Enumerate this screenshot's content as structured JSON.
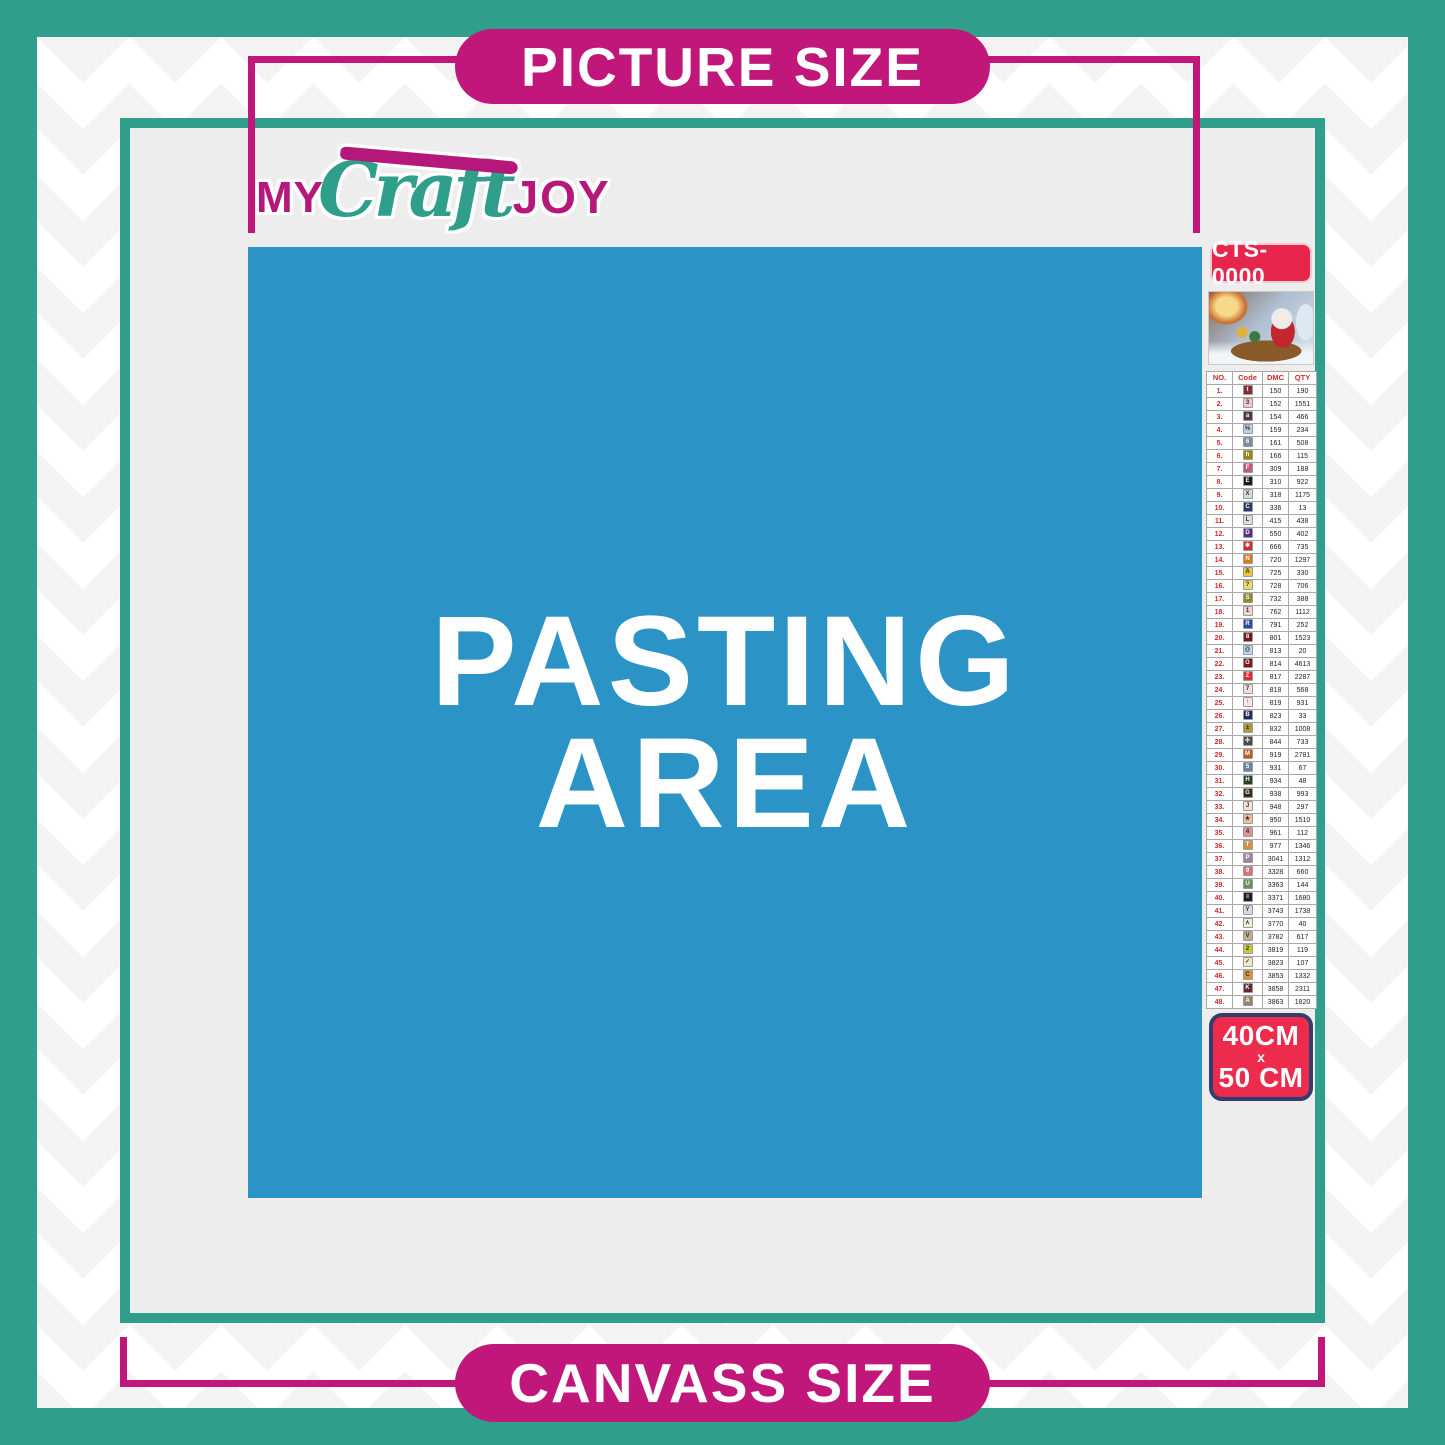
{
  "banners": {
    "top": "PICTURE SIZE",
    "bottom": "CANVASS SIZE"
  },
  "logo": {
    "word1": "MY",
    "word2": "Craft",
    "word3": "JOY"
  },
  "pasting_area": {
    "line1": "PASTING",
    "line2": "AREA"
  },
  "sidebar": {
    "product_code": "CTS-0000",
    "size_badge": {
      "line1": "40CM",
      "line2": "x",
      "line3": "50 CM"
    },
    "table": {
      "headers": [
        "NO.",
        "Code",
        "DMC",
        "QTY"
      ],
      "rows": [
        {
          "no": "1.",
          "code": "t",
          "chip": "#8A2A2E",
          "chip_text": "light",
          "dmc": "150",
          "qty": "190"
        },
        {
          "no": "2.",
          "code": "3",
          "chip": "#F0C6C9",
          "chip_text": "dark",
          "dmc": "152",
          "qty": "1551"
        },
        {
          "no": "3.",
          "code": "a",
          "chip": "#4E3A44",
          "chip_text": "light",
          "dmc": "154",
          "qty": "466"
        },
        {
          "no": "4.",
          "code": "%",
          "chip": "#C8CCE2",
          "chip_text": "dark",
          "dmc": "159",
          "qty": "234"
        },
        {
          "no": "5.",
          "code": "6",
          "chip": "#7B8CA4",
          "chip_text": "light",
          "dmc": "161",
          "qty": "508"
        },
        {
          "no": "6.",
          "code": "h",
          "chip": "#968A14",
          "chip_text": "light",
          "dmc": "166",
          "qty": "115"
        },
        {
          "no": "7.",
          "code": "F",
          "chip": "#C75A70",
          "chip_text": "light",
          "dmc": "309",
          "qty": "188"
        },
        {
          "no": "8.",
          "code": "E",
          "chip": "#1C1C1C",
          "chip_text": "light",
          "dmc": "310",
          "qty": "922"
        },
        {
          "no": "9.",
          "code": "X",
          "chip": "#D9D9D9",
          "chip_text": "dark",
          "dmc": "318",
          "qty": "1175"
        },
        {
          "no": "10.",
          "code": "C",
          "chip": "#2C3A68",
          "chip_text": "light",
          "dmc": "336",
          "qty": "13"
        },
        {
          "no": "11.",
          "code": "L",
          "chip": "#DEDEDE",
          "chip_text": "dark",
          "dmc": "415",
          "qty": "438"
        },
        {
          "no": "12.",
          "code": "D",
          "chip": "#5B2D8C",
          "chip_text": "light",
          "dmc": "550",
          "qty": "402"
        },
        {
          "no": "13.",
          "code": "✱",
          "chip": "#CE2B2B",
          "chip_text": "light",
          "dmc": "666",
          "qty": "735"
        },
        {
          "no": "14.",
          "code": "N",
          "chip": "#E0761C",
          "chip_text": "light",
          "dmc": "720",
          "qty": "1297"
        },
        {
          "no": "15.",
          "code": "Å",
          "chip": "#E5C53A",
          "chip_text": "dark",
          "dmc": "725",
          "qty": "330"
        },
        {
          "no": "16.",
          "code": "?",
          "chip": "#EDD867",
          "chip_text": "dark",
          "dmc": "728",
          "qty": "706"
        },
        {
          "no": "17.",
          "code": "S",
          "chip": "#8D8A22",
          "chip_text": "light",
          "dmc": "732",
          "qty": "388"
        },
        {
          "no": "18.",
          "code": "1",
          "chip": "#F4D2CD",
          "chip_text": "dark",
          "dmc": "762",
          "qty": "1112"
        },
        {
          "no": "19.",
          "code": "R",
          "chip": "#2C4AA6",
          "chip_text": "light",
          "dmc": "791",
          "qty": "252"
        },
        {
          "no": "20.",
          "code": "8",
          "chip": "#6B1E22",
          "chip_text": "light",
          "dmc": "801",
          "qty": "1523"
        },
        {
          "no": "21.",
          "code": "@",
          "chip": "#BFD8EE",
          "chip_text": "dark",
          "dmc": "813",
          "qty": "20"
        },
        {
          "no": "22.",
          "code": "O",
          "chip": "#771A1E",
          "chip_text": "light",
          "dmc": "814",
          "qty": "4613"
        },
        {
          "no": "23.",
          "code": "Z",
          "chip": "#DC3032",
          "chip_text": "light",
          "dmc": "817",
          "qty": "2287"
        },
        {
          "no": "24.",
          "code": "7",
          "chip": "#F6DBDB",
          "chip_text": "dark",
          "dmc": "818",
          "qty": "568"
        },
        {
          "no": "25.",
          "code": "↑",
          "chip": "#F8E4E2",
          "chip_text": "dark",
          "dmc": "819",
          "qty": "931"
        },
        {
          "no": "26.",
          "code": "B",
          "chip": "#202C5C",
          "chip_text": "light",
          "dmc": "823",
          "qty": "33"
        },
        {
          "no": "27.",
          "code": "±",
          "chip": "#AE983C",
          "chip_text": "dark",
          "dmc": "832",
          "qty": "1008"
        },
        {
          "no": "28.",
          "code": "✣",
          "chip": "#4B4B4B",
          "chip_text": "light",
          "dmc": "844",
          "qty": "733"
        },
        {
          "no": "29.",
          "code": "M",
          "chip": "#BE5A20",
          "chip_text": "light",
          "dmc": "919",
          "qty": "2781"
        },
        {
          "no": "30.",
          "code": "5",
          "chip": "#6D84A0",
          "chip_text": "light",
          "dmc": "931",
          "qty": "67"
        },
        {
          "no": "31.",
          "code": "H",
          "chip": "#2E3C2A",
          "chip_text": "light",
          "dmc": "934",
          "qty": "48"
        },
        {
          "no": "32.",
          "code": "G",
          "chip": "#39291E",
          "chip_text": "light",
          "dmc": "938",
          "qty": "993"
        },
        {
          "no": "33.",
          "code": "J",
          "chip": "#F8DFCE",
          "chip_text": "dark",
          "dmc": "948",
          "qty": "297"
        },
        {
          "no": "34.",
          "code": "★",
          "chip": "#EFBF9E",
          "chip_text": "dark",
          "dmc": "950",
          "qty": "1510"
        },
        {
          "no": "35.",
          "code": "4",
          "chip": "#E6909A",
          "chip_text": "dark",
          "dmc": "961",
          "qty": "112"
        },
        {
          "no": "36.",
          "code": "T",
          "chip": "#D78E48",
          "chip_text": "light",
          "dmc": "977",
          "qty": "1346"
        },
        {
          "no": "37.",
          "code": "P",
          "chip": "#98889E",
          "chip_text": "light",
          "dmc": "3041",
          "qty": "1312"
        },
        {
          "no": "38.",
          "code": "9",
          "chip": "#D7757B",
          "chip_text": "light",
          "dmc": "3328",
          "qty": "660"
        },
        {
          "no": "39.",
          "code": "U",
          "chip": "#6A8E5B",
          "chip_text": "light",
          "dmc": "3363",
          "qty": "144"
        },
        {
          "no": "40.",
          "code": "≡",
          "chip": "#202020",
          "chip_text": "light",
          "dmc": "3371",
          "qty": "1680"
        },
        {
          "no": "41.",
          "code": "Y",
          "chip": "#D7D7E9",
          "chip_text": "dark",
          "dmc": "3743",
          "qty": "1738"
        },
        {
          "no": "42.",
          "code": "∧",
          "chip": "#F4EDDB",
          "chip_text": "dark",
          "dmc": "3770",
          "qty": "40"
        },
        {
          "no": "43.",
          "code": "V",
          "chip": "#BFAD92",
          "chip_text": "dark",
          "dmc": "3782",
          "qty": "617"
        },
        {
          "no": "44.",
          "code": "2",
          "chip": "#C6CB38",
          "chip_text": "dark",
          "dmc": "3819",
          "qty": "119"
        },
        {
          "no": "45.",
          "code": "✓",
          "chip": "#F1E9C6",
          "chip_text": "dark",
          "dmc": "3823",
          "qty": "107"
        },
        {
          "no": "46.",
          "code": "C",
          "chip": "#DF9138",
          "chip_text": "dark",
          "dmc": "3853",
          "qty": "1332"
        },
        {
          "no": "47.",
          "code": "K",
          "chip": "#5D2C2C",
          "chip_text": "light",
          "dmc": "3858",
          "qty": "2311"
        },
        {
          "no": "48.",
          "code": "A",
          "chip": "#99836A",
          "chip_text": "light",
          "dmc": "3863",
          "qty": "1820"
        }
      ]
    }
  },
  "colors": {
    "teal": "#2F9E8A",
    "magenta": "#C1177A",
    "blue": "#2B93C5",
    "gray_panel": "#EDEDED",
    "badge_red": "#E8254B",
    "size_badge_red": "#EC2B4D",
    "size_badge_border": "#323F6D",
    "table_accent_red": "#D02A2A"
  }
}
